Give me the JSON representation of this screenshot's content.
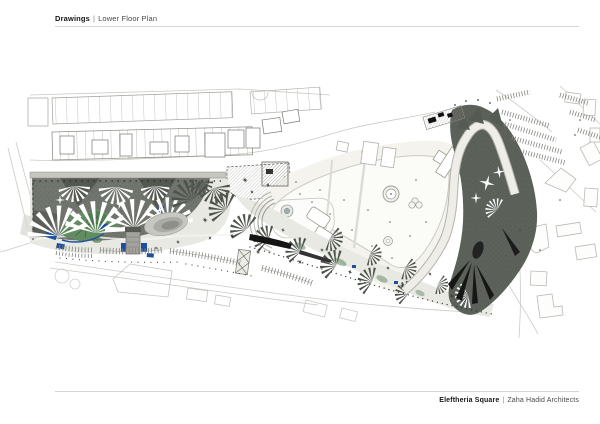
{
  "header": {
    "section": "Drawings",
    "divider": "|",
    "title": "Lower Floor Plan"
  },
  "footer": {
    "project": "Eleftheria Square",
    "divider": "|",
    "firm": "Zaha Hadid Architects"
  },
  "drawing": {
    "description": "Lower floor site plan drawing",
    "colors": {
      "square_band_light": "#e9e9e3",
      "square_band_dark": "#70766d",
      "square_band_deep": "#4d534c",
      "bastion_slope": "#5c615a",
      "road_band": "#eeede7",
      "road_edge": "#b4b4ac",
      "landscape_green": "#628c62",
      "water_blue": "#1d4f9e",
      "context_line": "#b9b9b4",
      "black_detail": "#141414",
      "wall_band": "#c6c6c0"
    }
  }
}
